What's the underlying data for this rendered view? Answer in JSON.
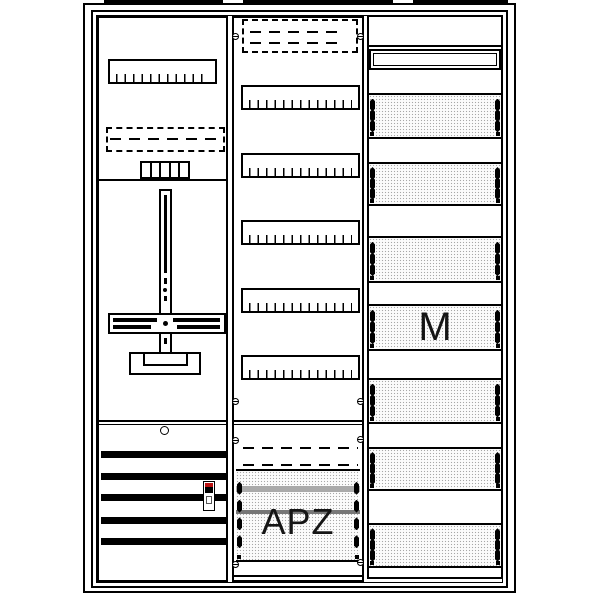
{
  "drawing": {
    "title": "meter-cabinet-line-drawing",
    "labels": {
      "apz": "APZ",
      "m": "M"
    },
    "colors": {
      "line": "#000000",
      "background": "#ffffff",
      "stipple_bg": "#fcfcfc",
      "stipple_dot": "#a8a8a8",
      "device_red": "#bb1111",
      "rail_band_light": "#aaaaaa",
      "rail_band_dark": "#777777",
      "label_text": "#151515"
    },
    "icons": {
      "screw": "slotted-screw-icon",
      "clip": "panel-clip-icon",
      "keyhole": "lock-hole-icon"
    }
  }
}
